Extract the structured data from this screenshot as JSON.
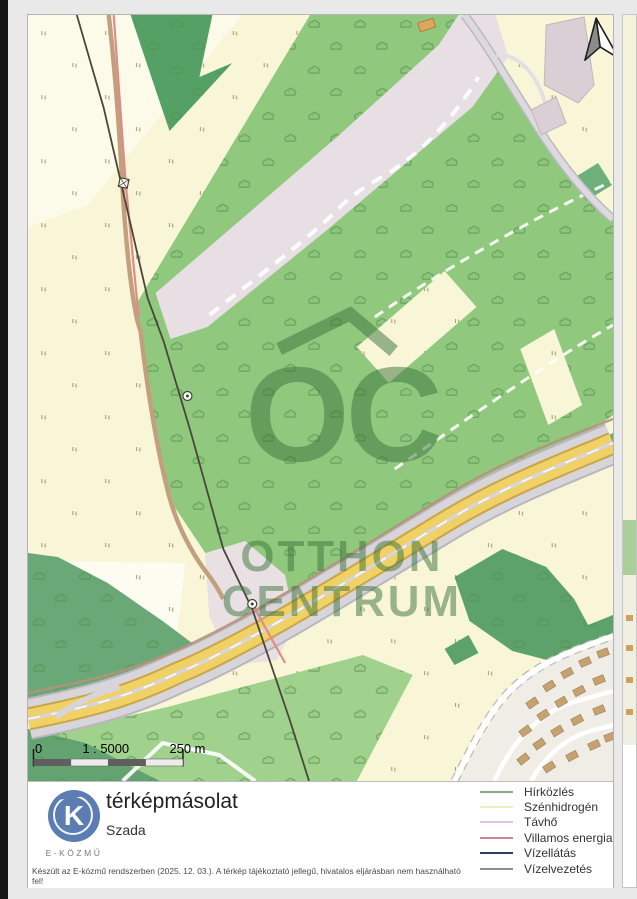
{
  "map": {
    "watermark": {
      "monogram": "OC",
      "line1": "OTTHON",
      "line2": "CENTRUM"
    },
    "scale_bar": {
      "zero_label": "0",
      "ratio_label": "1 : 5000",
      "distance_label": "250 m"
    },
    "colors": {
      "field": "#f8f6d7",
      "forest": "#90c87e",
      "forest_dark": "#5da26b",
      "corridor": "#e7dfe3",
      "highway_yellow": "#f0d166",
      "electric_line": "#e08a8a"
    }
  },
  "footer": {
    "logo": {
      "letter": "K",
      "caption": "E-KÖZMŰ"
    },
    "title": "térképmásolat",
    "subtitle": "Szada",
    "legend": [
      {
        "label": "Hírközlés",
        "color": "#8aa88a"
      },
      {
        "label": "Szénhidrogén",
        "color": "#efefbc"
      },
      {
        "label": "Távhő",
        "color": "#d9c6dc"
      },
      {
        "label": "Villamos energia",
        "color": "#cf868e"
      },
      {
        "label": "Vízellátás",
        "color": "#323c69"
      },
      {
        "label": "Vízelvezetés",
        "color": "#8f8aa0"
      }
    ],
    "disclaimer": "Készült az E-közmű rendszerben (2025. 12. 03.). A térkép tájékoztató jellegű, hivatalos eljárásban nem használható fel!"
  }
}
